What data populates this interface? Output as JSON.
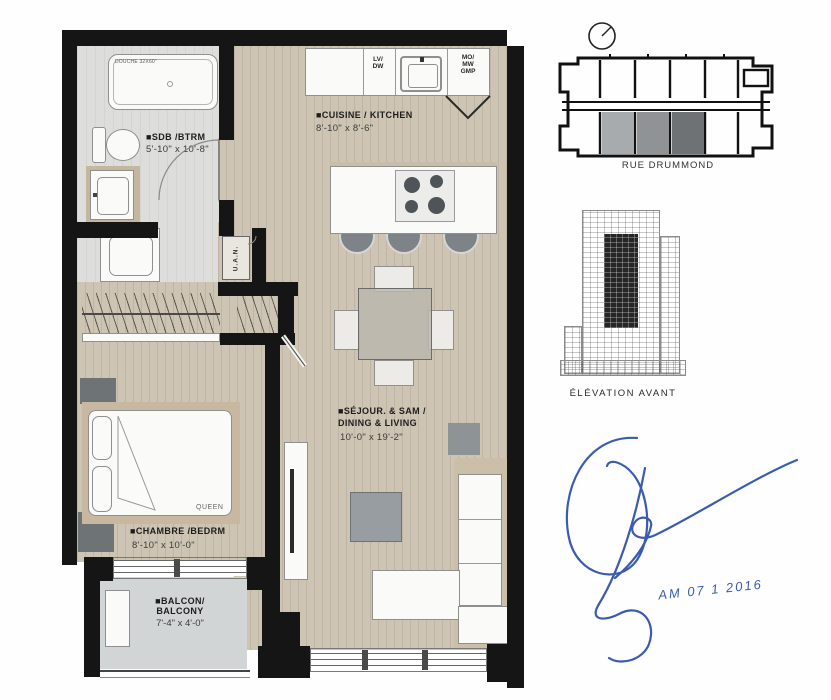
{
  "sheet": {
    "bathroom_label": "■SDB /BTRM",
    "bathroom_dims": "5'-10\" x 10'-8\"",
    "shower_label": "DOUCHE 32X60\"",
    "kitchen_label": "■CUISINE / KITCHEN",
    "kitchen_dims": "8'-10\" x 8'-6\"",
    "dw_line1": "LV/",
    "dw_line2": "DW",
    "pantry_line1": "MO/",
    "pantry_line2": "MW",
    "pantry_line3": "GMP",
    "living_label1": "■SÉJOUR. & SAM /",
    "living_label2": "DINING & LIVING",
    "living_dims": "10'-0\" x 19'-2\"",
    "bedroom_label": "■CHAMBRE /BEDRM",
    "bedroom_dims": "8'-10\" x 10'-0\"",
    "bed_size": "QUEEN",
    "balcony_label1": "■BALCON/",
    "balcony_label2": "BALCONY",
    "balcony_dims": "7'-4\" x 4'-0\"",
    "utility_label": "U.A.N."
  },
  "keyplan": {
    "street": "RUE DRUMMOND"
  },
  "elevation": {
    "caption": "ÉLÉVATION AVANT"
  },
  "signature": {
    "date": "AM 07 1 2016"
  },
  "colors": {
    "wall": "#151515",
    "wood_floor": "#cdc4b3",
    "bath_floor": "#dddddb",
    "balcony_floor": "#d2d5d6",
    "furniture_gray": "#8e9496",
    "signature_blue": "#3a5cb0"
  }
}
